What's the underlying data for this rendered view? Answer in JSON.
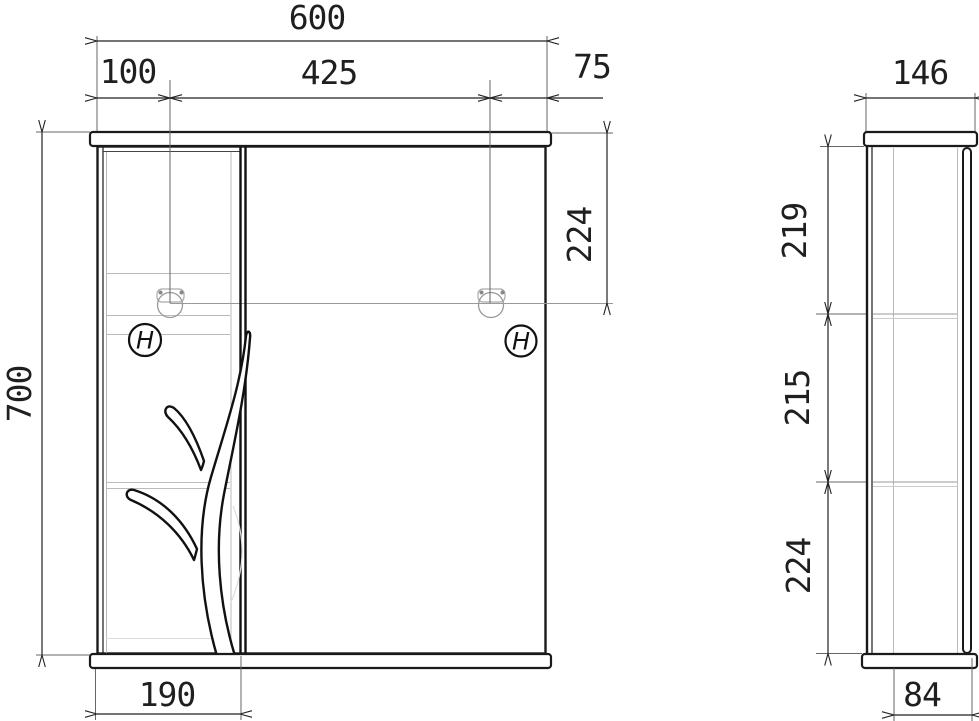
{
  "drawing": {
    "type": "technical-drawing",
    "subject": "mirror cabinet with sliding door and decorative branch, front and side views",
    "handle_mark": "H",
    "front": {
      "width_total": "600",
      "width_left": "100",
      "width_center": "425",
      "width_right": "75",
      "height_total": "700",
      "lamp_drop": "224",
      "bottom_section_width": "190"
    },
    "side": {
      "depth": "146",
      "shelf_gap_top": "219",
      "shelf_gap_middle": "215",
      "shelf_gap_bottom": "224",
      "base_depth": "84"
    },
    "colors": {
      "line": "#1f1f1f",
      "light_line": "#bbbbbb",
      "background": "#ffffff"
    }
  }
}
